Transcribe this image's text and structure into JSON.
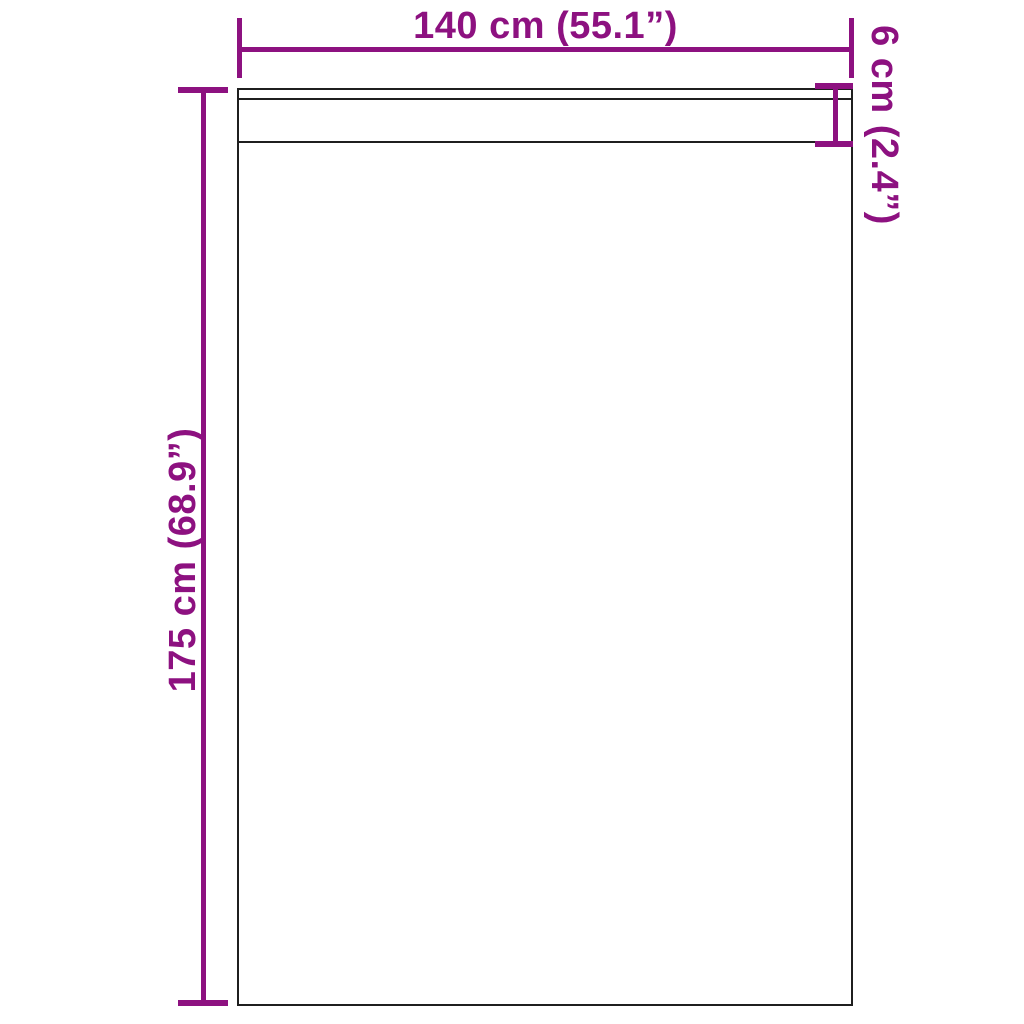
{
  "figure": {
    "colors": {
      "dimension": "#8d1180",
      "outline": "#1f1f1f",
      "background": "#ffffff"
    },
    "panel": {
      "width_label": "140 cm (55.1”)",
      "height_label": "175 cm (68.9”)",
      "header_label": "6 cm (2.4”)"
    }
  }
}
